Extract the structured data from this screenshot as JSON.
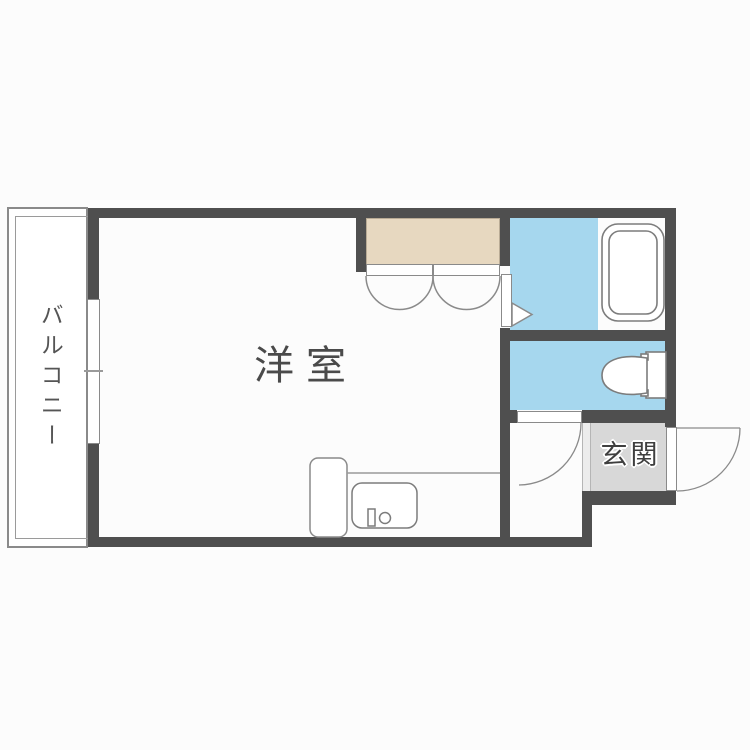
{
  "rooms": {
    "western_room": {
      "label": "洋室"
    },
    "balcony": {
      "label": "バルコニー"
    },
    "entrance": {
      "label": "玄関"
    }
  },
  "fixtures": {
    "bathtub": "bathtub",
    "toilet": "toilet",
    "kitchen_sink": "kitchen-sink",
    "kitchen_counter": "kitchen-counter",
    "refrigerator_space": "refrigerator-space",
    "closet_bifold_doors": "closet-bifold-doors",
    "window": "sliding-window",
    "bathroom_door": "bathroom-door-arrow",
    "toilet_door": "toilet-door-swing",
    "entrance_door": "entrance-door-swing"
  },
  "colors": {
    "wall": "#4f4f4f",
    "wet_area": "#a6d7ee",
    "closet": "#e7d8c0",
    "entrance_floor": "#d8d8d8",
    "entrance_step": "#ececec",
    "outline": "#8a8a8a",
    "label_text": "#4a4a4a",
    "background": "#fcfcfc"
  }
}
